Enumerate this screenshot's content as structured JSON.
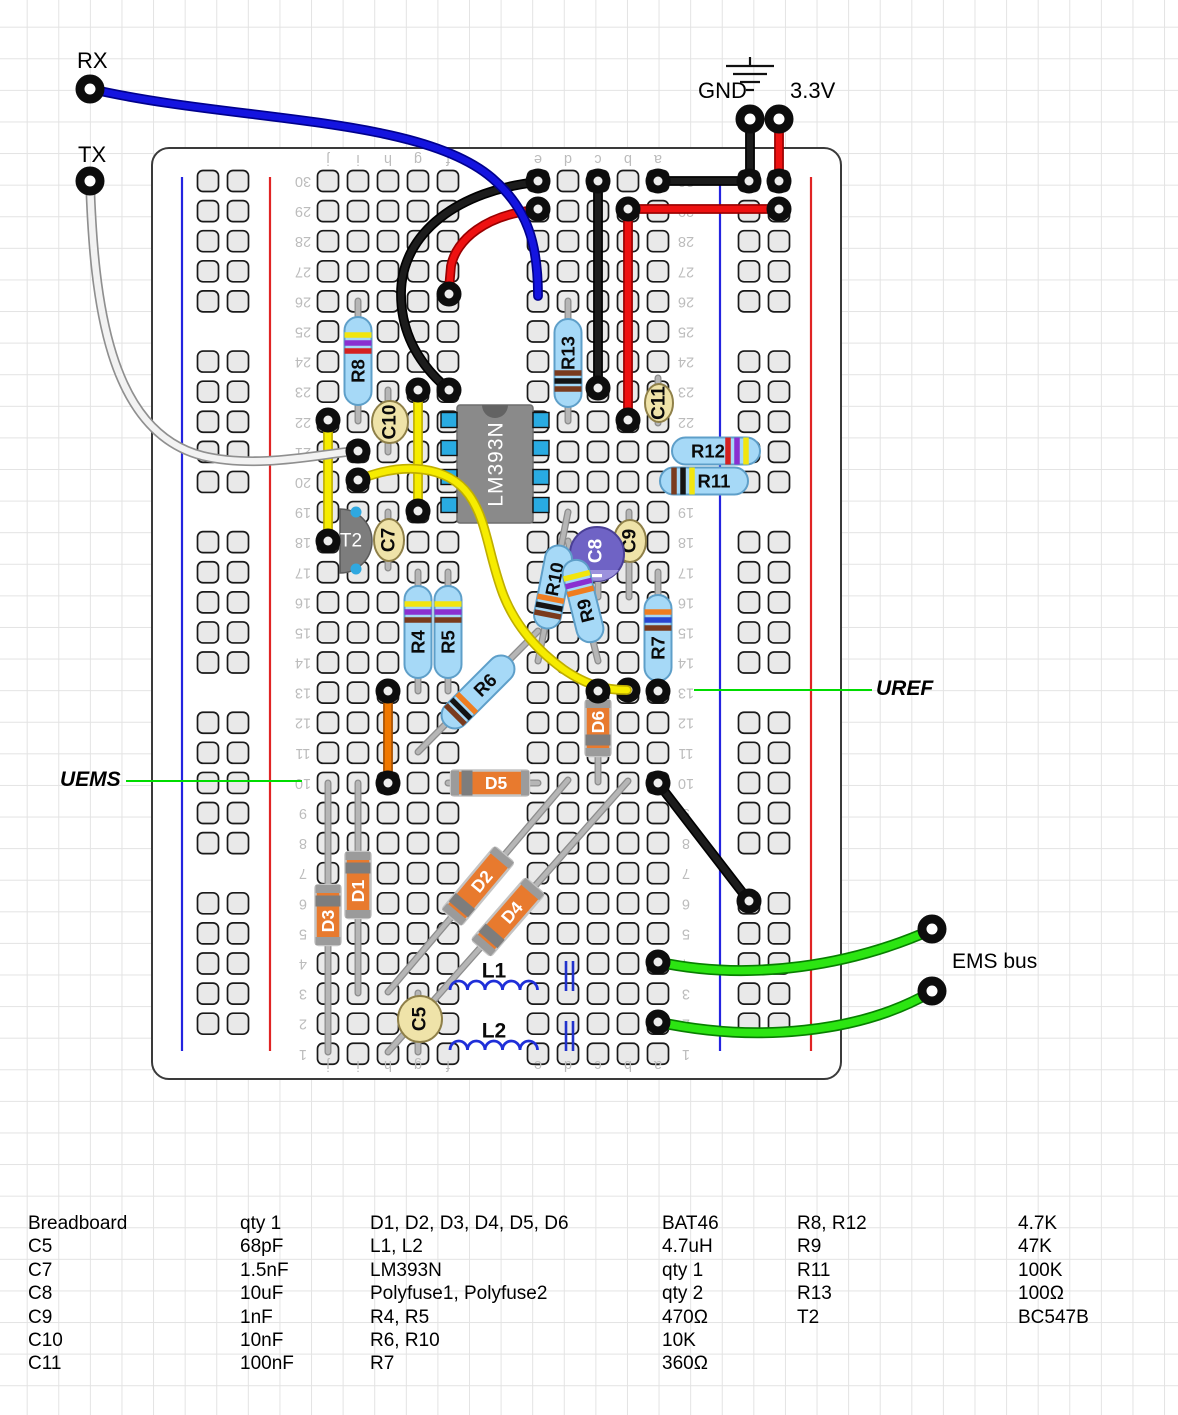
{
  "labels": {
    "rx": "RX",
    "tx": "TX",
    "gnd": "GND",
    "v33": "3.3V",
    "uref": "UREF",
    "uems": "UEMS",
    "ems_bus": "EMS bus"
  },
  "breadboard": {
    "column_letters": [
      "j",
      "i",
      "h",
      "g",
      "f",
      "e",
      "d",
      "c",
      "b",
      "a"
    ],
    "row_count": 30
  },
  "components": {
    "R4": {
      "label": "R4",
      "kind": "resistor",
      "value": "470Ω",
      "bands": [
        "yellow",
        "violet",
        "brown"
      ]
    },
    "R5": {
      "label": "R5",
      "kind": "resistor",
      "value": "470Ω",
      "bands": [
        "yellow",
        "violet",
        "brown"
      ]
    },
    "R6": {
      "label": "R6",
      "kind": "resistor",
      "value": "10K",
      "bands": [
        "brown",
        "black",
        "orange"
      ]
    },
    "R7": {
      "label": "R7",
      "kind": "resistor",
      "value": "360Ω",
      "bands": [
        "orange",
        "blue",
        "brown"
      ]
    },
    "R8": {
      "label": "R8",
      "kind": "resistor",
      "value": "4.7K",
      "bands": [
        "yellow",
        "violet",
        "red"
      ]
    },
    "R9": {
      "label": "R9",
      "kind": "resistor",
      "value": "47K",
      "bands": [
        "yellow",
        "violet",
        "orange"
      ]
    },
    "R10": {
      "label": "R10",
      "kind": "resistor",
      "value": "10K",
      "bands": [
        "brown",
        "black",
        "orange"
      ]
    },
    "R11": {
      "label": "R11",
      "kind": "resistor",
      "value": "100K",
      "bands": [
        "brown",
        "black",
        "yellow"
      ]
    },
    "R12": {
      "label": "R12",
      "kind": "resistor",
      "value": "4.7K",
      "bands": [
        "yellow",
        "violet",
        "red"
      ]
    },
    "R13": {
      "label": "R13",
      "kind": "resistor",
      "value": "100Ω",
      "bands": [
        "brown",
        "black",
        "brown"
      ]
    },
    "C5": {
      "label": "C5",
      "kind": "capacitor",
      "value": "68pF"
    },
    "C7": {
      "label": "C7",
      "kind": "capacitor",
      "value": "1.5nF"
    },
    "C8": {
      "label": "C8",
      "kind": "electrolytic-capacitor",
      "value": "10uF"
    },
    "C9": {
      "label": "C9",
      "kind": "capacitor",
      "value": "1nF"
    },
    "C10": {
      "label": "C10",
      "kind": "capacitor",
      "value": "10nF"
    },
    "C11": {
      "label": "C11",
      "kind": "capacitor",
      "value": "100nF"
    },
    "D1": {
      "label": "D1",
      "kind": "diode",
      "value": "BAT46"
    },
    "D2": {
      "label": "D2",
      "kind": "diode",
      "value": "BAT46"
    },
    "D3": {
      "label": "D3",
      "kind": "diode",
      "value": "BAT46"
    },
    "D4": {
      "label": "D4",
      "kind": "diode",
      "value": "BAT46"
    },
    "D5": {
      "label": "D5",
      "kind": "diode",
      "value": "BAT46"
    },
    "D6": {
      "label": "D6",
      "kind": "diode",
      "value": "BAT46"
    },
    "L1": {
      "label": "L1",
      "kind": "inductor",
      "value": "4.7uH"
    },
    "L2": {
      "label": "L2",
      "kind": "inductor",
      "value": "4.7uH"
    },
    "IC1": {
      "label": "LM393N",
      "kind": "ic"
    },
    "T2": {
      "label": "T2",
      "kind": "transistor",
      "value": "BC547B"
    },
    "PF1": {
      "label": "Polyfuse1",
      "kind": "polyfuse"
    },
    "PF2": {
      "label": "Polyfuse2",
      "kind": "polyfuse"
    }
  },
  "wires": {
    "rx": {
      "label": "RX",
      "color": "blue"
    },
    "tx": {
      "label": "TX",
      "color": "white"
    },
    "gnd_pin": {
      "label": "GND",
      "color": "black"
    },
    "gnd_rail_jumper": {
      "color": "black"
    },
    "gnd_column_c": {
      "color": "black"
    },
    "gnd_curve": {
      "color": "black"
    },
    "gnd_diagonal": {
      "color": "black"
    },
    "v33_pin": {
      "label": "3.3V",
      "color": "red"
    },
    "v33_row29": {
      "color": "red"
    },
    "v33_column_b": {
      "color": "red"
    },
    "v33_curve": {
      "color": "red"
    },
    "jumper_yellow_left": {
      "color": "yellow"
    },
    "jumper_yellow_mid": {
      "color": "yellow"
    },
    "jumper_yellow_long": {
      "color": "yellow"
    },
    "jumper_orange": {
      "color": "orange"
    },
    "ems_bus_1": {
      "label": "EMS bus",
      "color": "green"
    },
    "ems_bus_2": {
      "color": "green"
    }
  },
  "colors": {
    "board_outline": "#3a3a3a",
    "hole_fill": "#e9e9e9",
    "hole_stroke": "#1a1a1a",
    "rail_blue": "#2424e0",
    "rail_red": "#e02424",
    "print_gray": "#bcbcbc",
    "resistor_body": "#a6d9f7",
    "resistor_edge": "#5e9fc9",
    "cap_body": "#efe3a9",
    "cap_edge": "#8f8049",
    "cap_electro": "#6f63c5",
    "cap_electro_edge": "#4a3f96",
    "cap_electro_slice": "#9c92dd",
    "diode_body": "#e87a2e",
    "diode_edge": "#c4c4c4",
    "diode_band": "#7d7d7d",
    "diode_cap": "#9b9b9b",
    "ic_body": "#8a8a8a",
    "ic_edge": "#6e6e6e",
    "ic_notch": "#636363",
    "ic_pin": "#29abe2",
    "transistor_body": "#7d7d7d",
    "transistor_pin": "#2fa8e0",
    "lead": "#b6b6b6",
    "lead_edge": "#8d8d8d",
    "inductor": "#1f2fd8",
    "polyfuse": "#2233cc",
    "ring": "#0d0d0d",
    "annotation": "#00dc00",
    "bands": {
      "yellow": "#f2e50e",
      "violet": "#8a2fd0",
      "red": "#d42020",
      "brown": "#7a3b1e",
      "black": "#141414",
      "orange": "#ef7d20",
      "blue": "#2a46cf"
    },
    "wire": {
      "black": [
        "#000000",
        "#1c1c1c"
      ],
      "red": [
        "#990000",
        "#ee1111"
      ],
      "blue": [
        "#00008c",
        "#1414e0"
      ],
      "yellow": [
        "#bfae00",
        "#f6ec00"
      ],
      "orange": [
        "#a34e00",
        "#f07800"
      ],
      "green": [
        "#077f00",
        "#2ce512"
      ],
      "white": [
        "#8f8f8f",
        "#f2f2f2"
      ]
    }
  },
  "parts_list": {
    "rows": [
      [
        "Breadboard",
        "qty 1",
        "D1, D2, D3, D4, D5, D6",
        "BAT46",
        "R8, R12",
        "4.7K"
      ],
      [
        "C5",
        "68pF",
        "L1, L2",
        "4.7uH",
        "R9",
        "47K"
      ],
      [
        "C7",
        "1.5nF",
        "LM393N",
        "qty 1",
        "R11",
        "100K"
      ],
      [
        "C8",
        "10uF",
        "Polyfuse1, Polyfuse2",
        "qty 2",
        "R13",
        "100Ω"
      ],
      [
        "C9",
        "1nF",
        "R4, R5",
        "470Ω",
        "T2",
        "BC547B"
      ],
      [
        "C10",
        "10nF",
        "R6, R10",
        "10K",
        "",
        ""
      ],
      [
        "C11",
        "100nF",
        "R7",
        "360Ω",
        "",
        ""
      ]
    ]
  }
}
